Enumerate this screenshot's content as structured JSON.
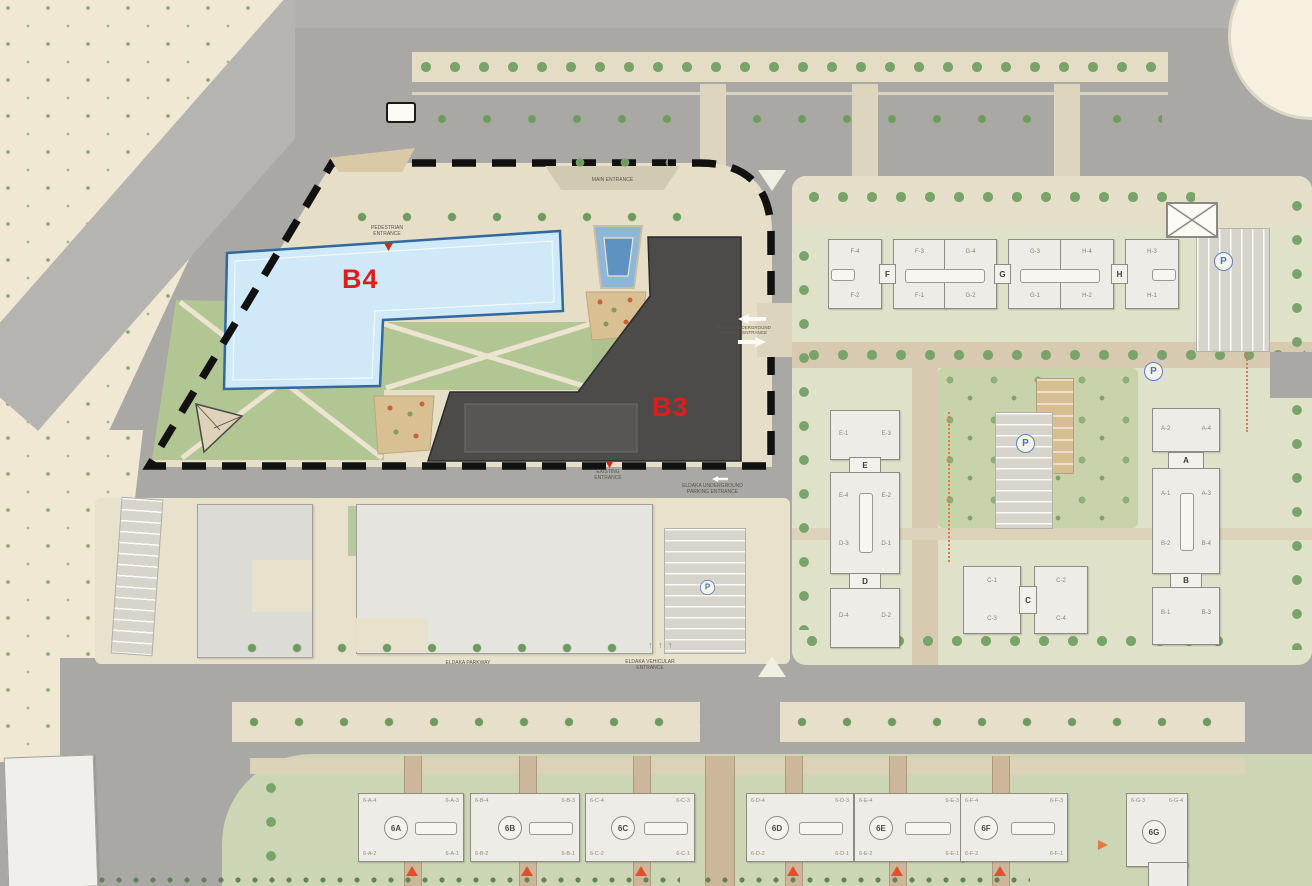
{
  "plan_labels": {
    "b4": "B4",
    "b3": "B3"
  },
  "colors": {
    "label_red": "#e31b18",
    "b4_fill": "#cfe9f8",
    "b3_fill": "#4c4b49",
    "water": "#5e92bf",
    "parking_blue": "#4a74b4",
    "boundary": "#111111"
  },
  "entrances": {
    "main": "MAIN ENTRANCE",
    "pedestrian_l1": "PEDESTRIAN",
    "pedestrian_l2": "ENTRANCE",
    "ug_b3b4_l1": "B3 & B4 UNDERGROUND",
    "ug_b3b4_l2": "PARKING ENTRANCE",
    "existing_l1": "EXISTING",
    "existing_l2": "ENTRANCE",
    "eldaka_ug_l1": "ELDAKA UNDERGROUND",
    "eldaka_ug_l2": "PARKING ENTRANCE",
    "parkway": "ELDAKA PARKWAY",
    "vehicular_l1": "ELDAKA VEHICULAR",
    "vehicular_l2": "ENTRANCE",
    "parking": "P"
  },
  "icons": {
    "up_arrow": "↑"
  },
  "north_row": {
    "tabs": [
      "F",
      "G",
      "H"
    ],
    "wings": [
      {
        "top": "F-4",
        "bottom": "F-2"
      },
      {
        "top": "F-3",
        "bottom": "F-1"
      },
      {
        "top": "G-4",
        "bottom": "G-2"
      },
      {
        "top": "G-3",
        "bottom": "G-1"
      },
      {
        "top": "H-4",
        "bottom": "H-2"
      },
      {
        "top": "H-3",
        "bottom": "H-1"
      }
    ]
  },
  "east": {
    "ed": {
      "b1": {
        "l": "E-1",
        "r": "E-3"
      },
      "tab1": "E",
      "b2": {
        "ul": "E-4",
        "ur": "E-2",
        "ll": "D-3",
        "lr": "D-1"
      },
      "tab2": "D",
      "b3": {
        "l": "D-4",
        "r": "D-2"
      }
    },
    "ab": {
      "b1": {
        "l": "A-2",
        "r": "A-4"
      },
      "tab1": "A",
      "b2": {
        "ul": "A-1",
        "ur": "A-3",
        "ll": "B-2",
        "lr": "B-4"
      },
      "tab2": "B",
      "b3": {
        "l": "B-1",
        "r": "B-3"
      }
    },
    "c": {
      "tab": "C",
      "tl": "C-1",
      "tr": "C-2",
      "bl": "C-3",
      "br": "C-4"
    }
  },
  "south_row": [
    {
      "tag": "6A",
      "tl": "6-A-4",
      "tr": "6-A-3",
      "bl": "6-A-2",
      "br": "6-A-1"
    },
    {
      "tag": "6B",
      "tl": "6-B-4",
      "tr": "6-B-3",
      "bl": "6-B-2",
      "br": "6-B-1"
    },
    {
      "tag": "6C",
      "tl": "6-C-4",
      "tr": "6-C-3",
      "bl": "6-C-2",
      "br": "6-C-1"
    },
    {
      "tag": "6D",
      "tl": "6-D-4",
      "tr": "6-D-3",
      "bl": "6-D-2",
      "br": "6-D-1"
    },
    {
      "tag": "6E",
      "tl": "6-E-4",
      "tr": "6-E-3",
      "bl": "6-E-2",
      "br": "6-E-1"
    },
    {
      "tag": "6F",
      "tl": "6-F-4",
      "tr": "6-F-3",
      "bl": "6-F-2",
      "br": "6-F-1"
    },
    {
      "tag": "6G",
      "tl": "6-G-3",
      "tr": "6-G-4"
    }
  ]
}
